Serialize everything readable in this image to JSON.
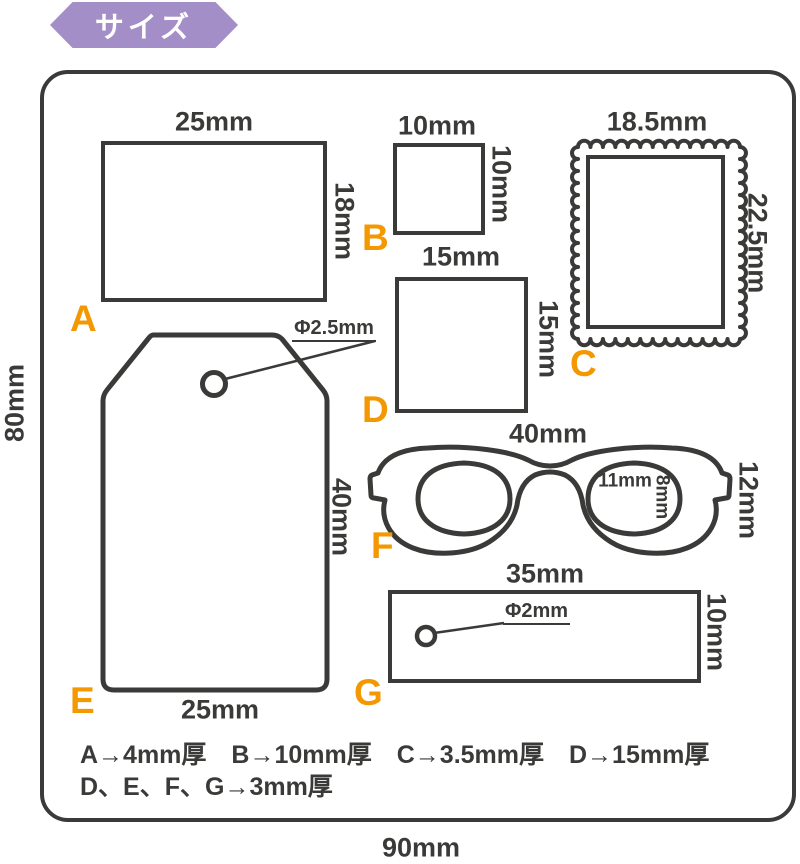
{
  "badge": {
    "label": "サイズ"
  },
  "overall": {
    "height_label": "80mm",
    "width_label": "90mm"
  },
  "shapes": [
    {
      "id": "A",
      "label": "A",
      "type": "rectangle",
      "width_label": "25mm",
      "height_label": "18mm"
    },
    {
      "id": "B",
      "label": "B",
      "type": "square",
      "width_label": "10mm",
      "height_label": "10mm"
    },
    {
      "id": "C",
      "label": "C",
      "type": "stamp",
      "width_label": "18.5mm",
      "height_label": "22.5mm"
    },
    {
      "id": "D",
      "label": "D",
      "type": "square",
      "width_label": "15mm",
      "height_label": "15mm"
    },
    {
      "id": "E",
      "label": "E",
      "type": "tag",
      "width_label": "25mm",
      "height_label": "40mm",
      "hole_label": "Φ2.5mm"
    },
    {
      "id": "F",
      "label": "F",
      "type": "glasses",
      "width_label": "40mm",
      "height_label": "12mm",
      "lens_width_label": "11mm",
      "lens_height_label": "8mm"
    },
    {
      "id": "G",
      "label": "G",
      "type": "rectangle",
      "width_label": "35mm",
      "height_label": "10mm",
      "hole_label": "Φ2mm"
    }
  ],
  "notes": {
    "line1": "A→4mm厚　B→10mm厚　C→3.5mm厚　D→15mm厚",
    "line2": "D、E、F、G→3mm厚"
  },
  "colors": {
    "accent_orange": "#f39800",
    "badge_purple": "#a48ec8",
    "line_dark": "#3a3a38"
  }
}
